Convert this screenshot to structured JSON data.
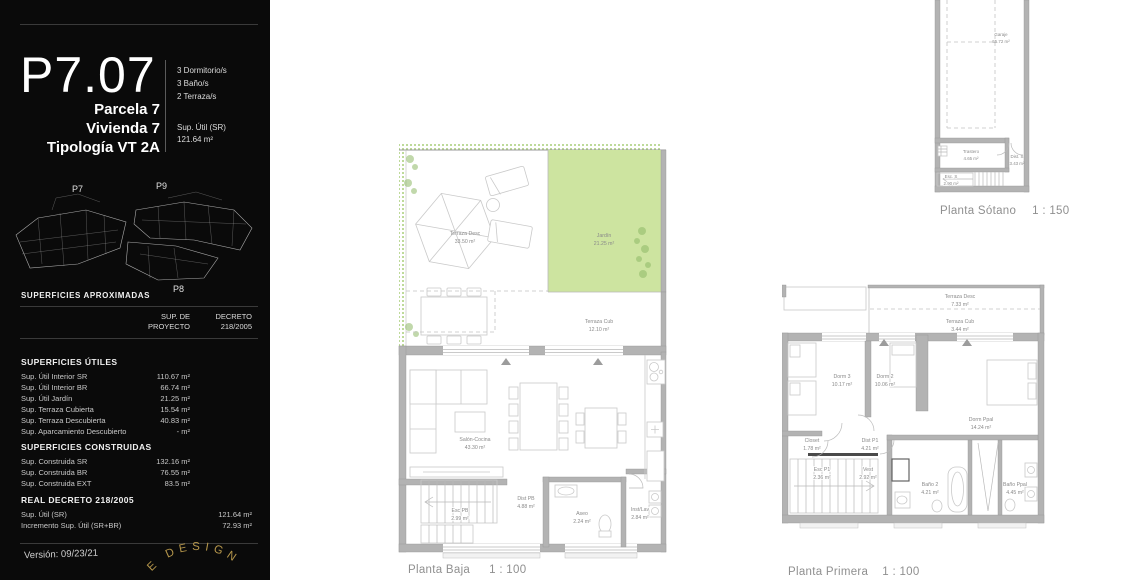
{
  "sidebar": {
    "unit_code": "P7.07",
    "specs": {
      "dorms": "3 Dormitorio/s",
      "banos": "3 Baño/s",
      "terrazas": "2 Terraza/s"
    },
    "identity": {
      "parcela": "Parcela 7",
      "vivienda": "Vivienda 7",
      "tipologia": "Tipología VT 2A"
    },
    "sup_util": {
      "label": "Sup. Útil (SR)",
      "value": "121.64 m²"
    },
    "siteplan": {
      "p7": "P7",
      "p9": "P9",
      "p8": "P8"
    },
    "approx_title": "SUPERFICIES APROXIMADAS",
    "table_header": {
      "col1_line1": "SUP. DE",
      "col1_line2": "PROYECTO",
      "col2_line1": "DECRETO",
      "col2_line2": "218/2005"
    },
    "utiles": {
      "title": "SUPERFICIES ÚTILES",
      "rows": [
        {
          "label": "Sup. Útil Interior SR",
          "value": "110.67 m²"
        },
        {
          "label": "Sup. Útil Interior BR",
          "value": "66.74 m²"
        },
        {
          "label": "Sup. Útil Jardín",
          "value": "21.25 m²"
        },
        {
          "label": "Sup. Terraza Cubierta",
          "value": "15.54 m²"
        },
        {
          "label": "Sup. Terraza Descubierta",
          "value": "40.83 m²"
        },
        {
          "label": "Sup. Aparcamiento Descubierto",
          "value": "- m²"
        }
      ]
    },
    "construidas": {
      "title": "SUPERFICIES CONSTRUIDAS",
      "rows": [
        {
          "label": "Sup. Construida SR",
          "value": "132.16 m²"
        },
        {
          "label": "Sup. Construida BR",
          "value": "76.55 m²"
        },
        {
          "label": "Sup. Construida EXT",
          "value": "83.5 m²"
        }
      ]
    },
    "decreto": {
      "title": "REAL DECRETO 218/2005",
      "rows": [
        {
          "label": "Sup. Útil (SR)",
          "value": "121.64 m²"
        },
        {
          "label": "Incremento Sup. Útil (SR+BR)",
          "value": "72.93 m²"
        }
      ]
    },
    "version": "Versión: 09/23/21",
    "logo_arc_text": "E DESIGN"
  },
  "plans": {
    "baja": {
      "caption": "Planta Baja",
      "scale": "1 : 100",
      "rooms": {
        "terraza_desc": {
          "name": "Terraza Desc",
          "area": "33.50 m²"
        },
        "jardin": {
          "name": "Jardín",
          "area": "21.25 m²"
        },
        "terraza_cub": {
          "name": "Terraza Cub",
          "area": "12.10 m²"
        },
        "salon": {
          "name": "Salón-Cocina",
          "area": "43.30 m²"
        },
        "dist": {
          "name": "Dist PB",
          "area": "4.88 m²"
        },
        "esc": {
          "name": "Esc PB",
          "area": "2.99 m²"
        },
        "aseo": {
          "name": "Aseo",
          "area": "2.24 m²"
        },
        "inst": {
          "name": "Inst/Lav",
          "area": "2.84 m²"
        }
      }
    },
    "primera": {
      "caption": "Planta Primera",
      "scale": "1 : 100",
      "rooms": {
        "terraza_desc": {
          "name": "Terraza Desc",
          "area": "7.33 m²"
        },
        "terraza_cub": {
          "name": "Terraza Cub",
          "area": "3.44 m²"
        },
        "dorm3": {
          "name": "Dorm 3",
          "area": "10.17 m²"
        },
        "dorm2": {
          "name": "Dorm 2",
          "area": "10.06 m²"
        },
        "dorm_ppal": {
          "name": "Dorm Ppal",
          "area": "14.24 m²"
        },
        "closet": {
          "name": "Closet",
          "area": "1.78 m²"
        },
        "dist": {
          "name": "Dist P1",
          "area": "4.21 m²"
        },
        "esc": {
          "name": "Esc P1",
          "area": "2.36 m²"
        },
        "vest": {
          "name": "Vest",
          "area": "2.92 m²"
        },
        "bano2": {
          "name": "Baño 2",
          "area": "4.21 m²"
        },
        "bano_ppal": {
          "name": "Baño Ppal",
          "area": "4.45 m²"
        }
      }
    },
    "sotano": {
      "caption": "Planta Sótano",
      "scale": "1 : 150",
      "rooms": {
        "garaje": {
          "name": "Garaje",
          "area": "55.72 m²"
        },
        "trastero": {
          "name": "Trastero",
          "area": "4.65 m²"
        },
        "dist": {
          "name": "Dist. S",
          "area": "3.43 m²"
        },
        "esc": {
          "name": "Esc. S",
          "area": "2.90 m²"
        }
      }
    }
  },
  "colors": {
    "garden_green": "#cde4a0",
    "hatch_green": "#a9cf7a",
    "wall_gray": "#b3b3b3",
    "gold": "#b5964b",
    "sidebar_bg": "#0a0a0a"
  }
}
